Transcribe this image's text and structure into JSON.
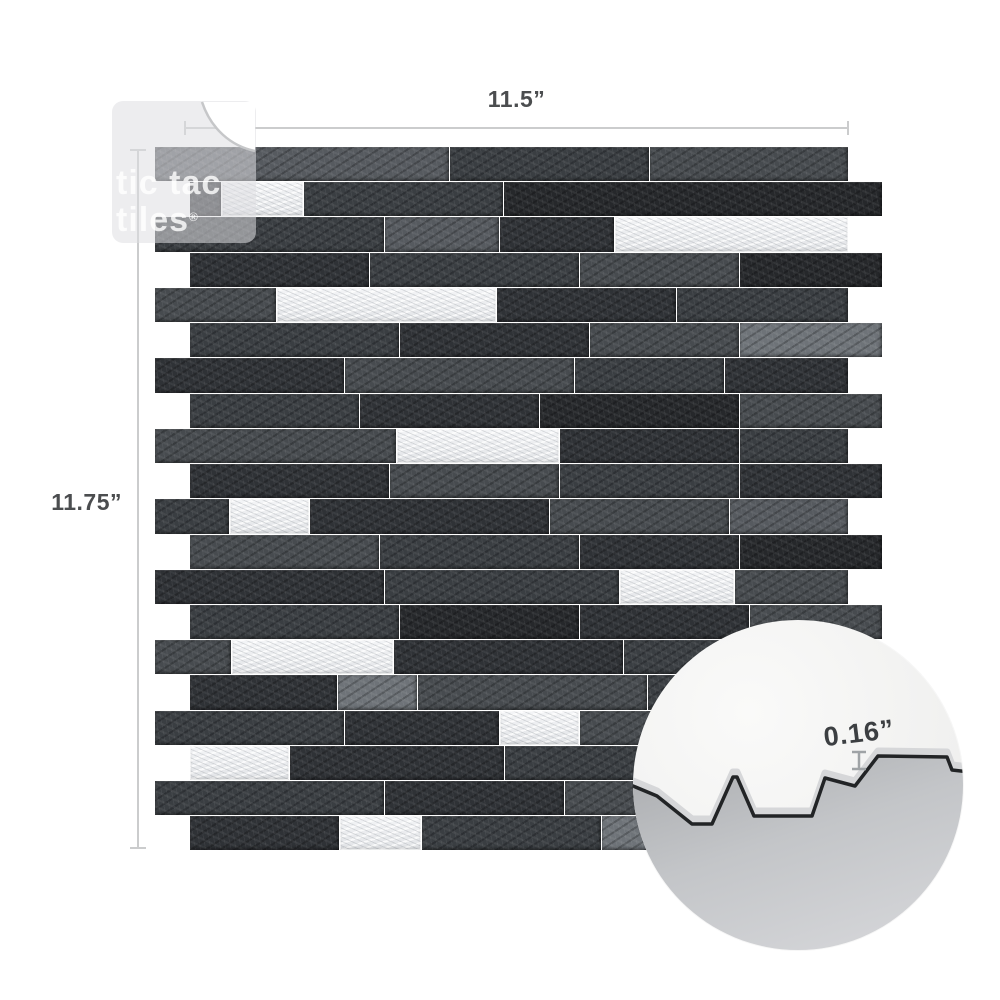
{
  "page": {
    "background": "#ffffff"
  },
  "brand": {
    "logo_line1": "tic tac",
    "logo_line2": "tiles",
    "registered_mark": "®"
  },
  "dimensions": {
    "width_label": "11.5”",
    "height_label": "11.75”"
  },
  "inset": {
    "thickness_label": "0.16”",
    "gray_path": "M -8,168 L 0,166 L 24,176 L 59,204 L 79,204 L 100,157 L 104,157 L 121,196 L 179,196 L 192,158 L 222,166 L 245,136 L 314,137 L 319,150 L 336,152 L 338,340 L -8,340 Z",
    "edge_line_path": "M -8,168 L 0,166 L 24,176 L 59,204 L 79,204 L 100,157 L 104,157 L 121,196 L 179,196 L 192,158 L 222,166 L 245,136 L 314,137 L 319,150 L 336,152",
    "band_line_path": "M -8,163 L 0,161 L 24,171 L 59,199 L 79,199 L 100,152 L 104,152 L 121,191 L 179,191 L 192,153 L 222,161 L 245,131 L 314,132 L 319,145 L 336,147"
  },
  "colors": {
    "dimension_line": "#cbcccd",
    "dimension_text": "#4b4d4f",
    "inset_text": "#3c3f42",
    "inset_marker": "#9fa3a6",
    "silver": "#e9ebee",
    "shades": {
      "xd": "#26282b",
      "d1": "#2f3236",
      "d2": "#3a3e42",
      "d3": "#474b4f",
      "m": "#565a5f",
      "l": "#6e7378",
      "s": "#e9ebee"
    }
  },
  "tile": {
    "row_heights_note": "y = top of row in px; rows staggered: odd rows start x=155, even rows x=190",
    "rows": [
      {
        "y": 147,
        "h": 35,
        "x": 155,
        "bricks": [
          {
            "w": 295,
            "c": "m"
          },
          {
            "w": 200,
            "c": "d2"
          },
          {
            "w": 199,
            "c": "d3"
          }
        ]
      },
      {
        "y": 182,
        "h": 35,
        "x": 190,
        "bricks": [
          {
            "w": 32,
            "c": "d1"
          },
          {
            "w": 82,
            "c": "s"
          },
          {
            "w": 200,
            "c": "d2"
          },
          {
            "w": 379,
            "c": "xd"
          }
        ]
      },
      {
        "y": 217,
        "h": 36,
        "x": 155,
        "bricks": [
          {
            "w": 230,
            "c": "d2"
          },
          {
            "w": 115,
            "c": "m"
          },
          {
            "w": 115,
            "c": "d1"
          },
          {
            "w": 234,
            "c": "s"
          }
        ]
      },
      {
        "y": 253,
        "h": 35,
        "x": 190,
        "bricks": [
          {
            "w": 180,
            "c": "d1"
          },
          {
            "w": 210,
            "c": "d2"
          },
          {
            "w": 160,
            "c": "d3"
          },
          {
            "w": 143,
            "c": "xd"
          }
        ]
      },
      {
        "y": 288,
        "h": 35,
        "x": 155,
        "bricks": [
          {
            "w": 122,
            "c": "d3"
          },
          {
            "w": 220,
            "c": "s"
          },
          {
            "w": 180,
            "c": "d1"
          },
          {
            "w": 172,
            "c": "d2"
          }
        ]
      },
      {
        "y": 323,
        "h": 35,
        "x": 190,
        "bricks": [
          {
            "w": 210,
            "c": "d2"
          },
          {
            "w": 190,
            "c": "d1"
          },
          {
            "w": 150,
            "c": "d3"
          },
          {
            "w": 143,
            "c": "l"
          }
        ]
      },
      {
        "y": 358,
        "h": 36,
        "x": 155,
        "bricks": [
          {
            "w": 190,
            "c": "d1"
          },
          {
            "w": 230,
            "c": "d3"
          },
          {
            "w": 150,
            "c": "d2"
          },
          {
            "w": 124,
            "c": "d1"
          }
        ]
      },
      {
        "y": 394,
        "h": 35,
        "x": 190,
        "bricks": [
          {
            "w": 170,
            "c": "d2"
          },
          {
            "w": 180,
            "c": "d1"
          },
          {
            "w": 200,
            "c": "xd"
          },
          {
            "w": 143,
            "c": "d3"
          }
        ]
      },
      {
        "y": 429,
        "h": 35,
        "x": 155,
        "bricks": [
          {
            "w": 242,
            "c": "d3"
          },
          {
            "w": 163,
            "c": "s"
          },
          {
            "w": 180,
            "c": "d1"
          },
          {
            "w": 109,
            "c": "d2"
          }
        ]
      },
      {
        "y": 464,
        "h": 35,
        "x": 190,
        "bricks": [
          {
            "w": 200,
            "c": "d1"
          },
          {
            "w": 170,
            "c": "d3"
          },
          {
            "w": 180,
            "c": "d2"
          },
          {
            "w": 143,
            "c": "d1"
          }
        ]
      },
      {
        "y": 499,
        "h": 36,
        "x": 155,
        "bricks": [
          {
            "w": 75,
            "c": "d2"
          },
          {
            "w": 80,
            "c": "s"
          },
          {
            "w": 240,
            "c": "d1"
          },
          {
            "w": 180,
            "c": "d3"
          },
          {
            "w": 119,
            "c": "m"
          }
        ]
      },
      {
        "y": 535,
        "h": 35,
        "x": 190,
        "bricks": [
          {
            "w": 190,
            "c": "d3"
          },
          {
            "w": 200,
            "c": "d2"
          },
          {
            "w": 160,
            "c": "d1"
          },
          {
            "w": 143,
            "c": "xd"
          }
        ]
      },
      {
        "y": 570,
        "h": 35,
        "x": 155,
        "bricks": [
          {
            "w": 230,
            "c": "d1"
          },
          {
            "w": 235,
            "c": "d2"
          },
          {
            "w": 115,
            "c": "s"
          },
          {
            "w": 114,
            "c": "d3"
          }
        ]
      },
      {
        "y": 605,
        "h": 35,
        "x": 190,
        "bricks": [
          {
            "w": 210,
            "c": "d2"
          },
          {
            "w": 180,
            "c": "xd"
          },
          {
            "w": 170,
            "c": "d1"
          },
          {
            "w": 133,
            "c": "d3"
          }
        ]
      },
      {
        "y": 640,
        "h": 35,
        "x": 155,
        "bricks": [
          {
            "w": 77,
            "c": "d3"
          },
          {
            "w": 162,
            "c": "s"
          },
          {
            "w": 230,
            "c": "d1"
          },
          {
            "w": 225,
            "c": "d2"
          }
        ]
      },
      {
        "y": 675,
        "h": 36,
        "x": 190,
        "bricks": [
          {
            "w": 148,
            "c": "d1"
          },
          {
            "w": 80,
            "c": "l"
          },
          {
            "w": 230,
            "c": "d3"
          },
          {
            "w": 235,
            "c": "d2"
          }
        ]
      },
      {
        "y": 711,
        "h": 35,
        "x": 155,
        "bricks": [
          {
            "w": 190,
            "c": "d2"
          },
          {
            "w": 155,
            "c": "d1"
          },
          {
            "w": 80,
            "c": "s"
          },
          {
            "w": 269,
            "c": "d3"
          }
        ]
      },
      {
        "y": 746,
        "h": 35,
        "x": 190,
        "bricks": [
          {
            "w": 100,
            "c": "s"
          },
          {
            "w": 215,
            "c": "d1"
          },
          {
            "w": 190,
            "c": "d2"
          },
          {
            "w": 188,
            "c": "d3"
          }
        ]
      },
      {
        "y": 781,
        "h": 35,
        "x": 155,
        "bricks": [
          {
            "w": 230,
            "c": "d2"
          },
          {
            "w": 180,
            "c": "d1"
          },
          {
            "w": 160,
            "c": "d3"
          },
          {
            "w": 124,
            "c": "d2"
          }
        ]
      },
      {
        "y": 816,
        "h": 35,
        "x": 190,
        "bricks": [
          {
            "w": 150,
            "c": "d1"
          },
          {
            "w": 82,
            "c": "s"
          },
          {
            "w": 180,
            "c": "d2"
          },
          {
            "w": 90,
            "c": "l"
          },
          {
            "w": 191,
            "c": "d3"
          }
        ]
      }
    ]
  }
}
